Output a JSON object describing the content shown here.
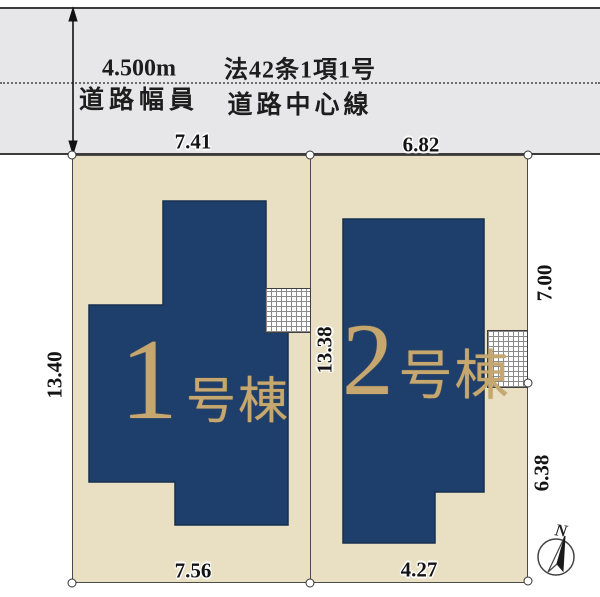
{
  "road": {
    "width_value": "4.500m",
    "width_caption": "道路幅員",
    "law": "法42条1項1号",
    "centerline_label": "道路中心線"
  },
  "dimensions": {
    "lot1_top": "7.41",
    "lot2_top": "6.82",
    "lot1_left": "13.40",
    "shared_middle": "13.38",
    "lot2_right_upper": "7.00",
    "lot2_right_lower": "6.38",
    "lot1_bottom": "7.56",
    "lot2_bottom": "4.27"
  },
  "buildings": [
    {
      "number": "1",
      "suffix": "号棟"
    },
    {
      "number": "2",
      "suffix": "号棟"
    }
  ],
  "compass": {
    "north": "N"
  },
  "colors": {
    "road_fill": "#e7e7e9",
    "lot_fill": "#e9e0c4",
    "building_fill": "#1e3e6b",
    "building_text_gold": "#c6a76f",
    "line": "#3c3c3c"
  }
}
